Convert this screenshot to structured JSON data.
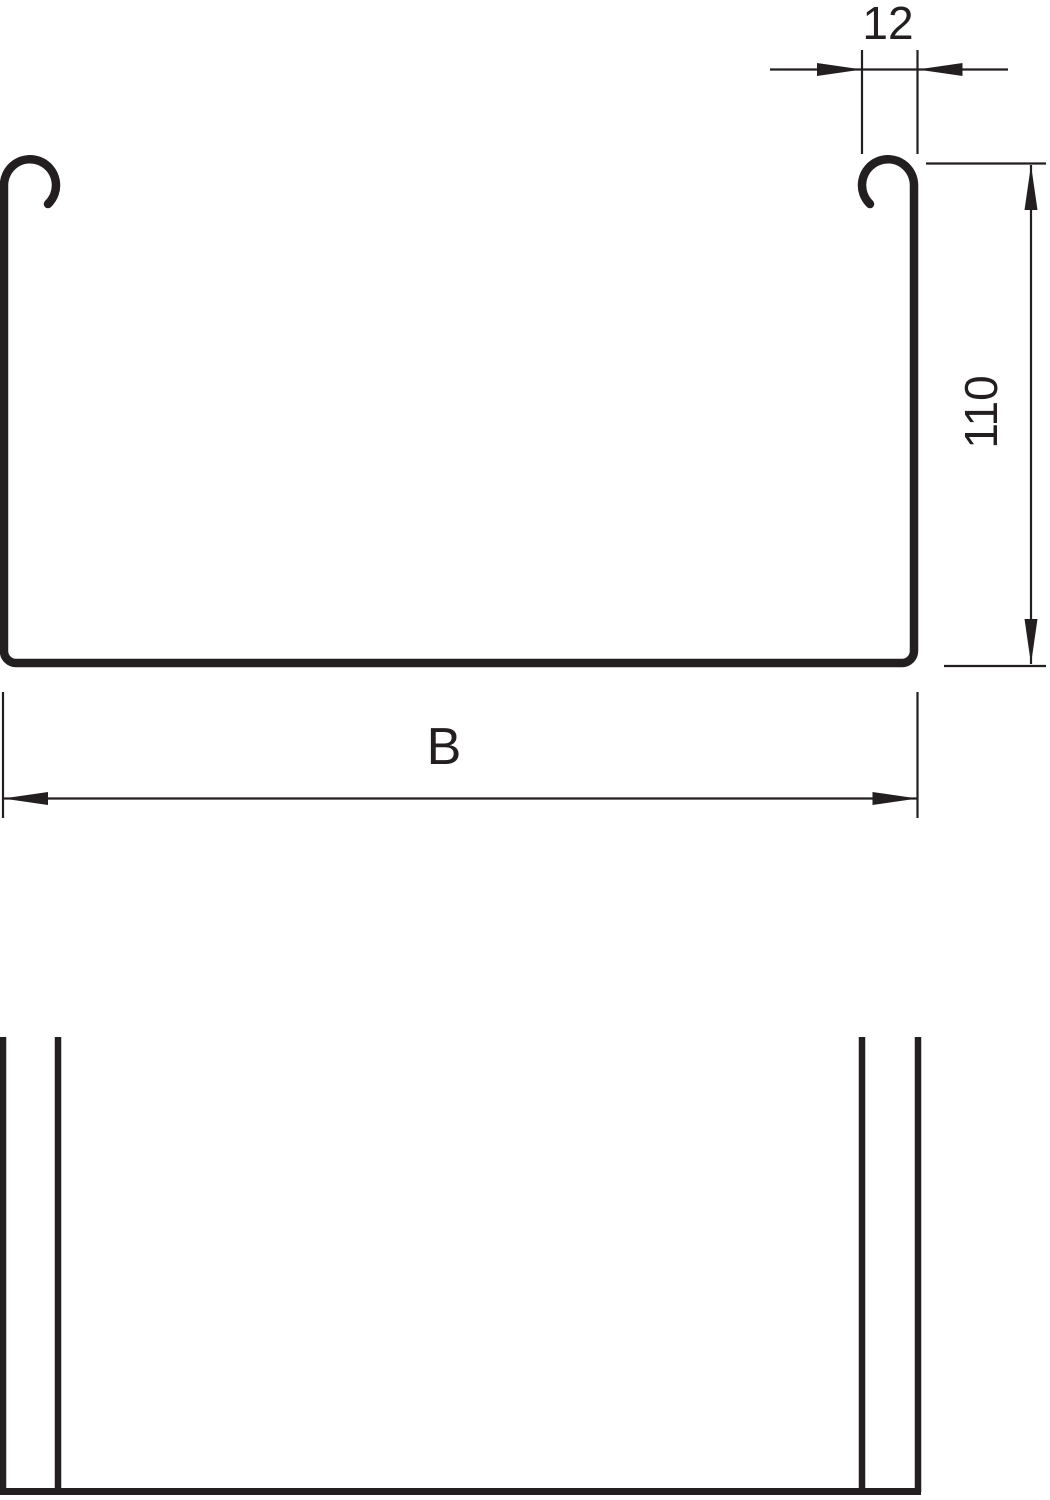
{
  "drawing": {
    "title": "cable tray profile technical drawing",
    "line_color": "#231f20",
    "background_color": "#ffffff"
  },
  "dimensions": {
    "rim_width": {
      "label": "12"
    },
    "side_height": {
      "label": "110"
    },
    "overall_width": {
      "label": "B"
    }
  }
}
